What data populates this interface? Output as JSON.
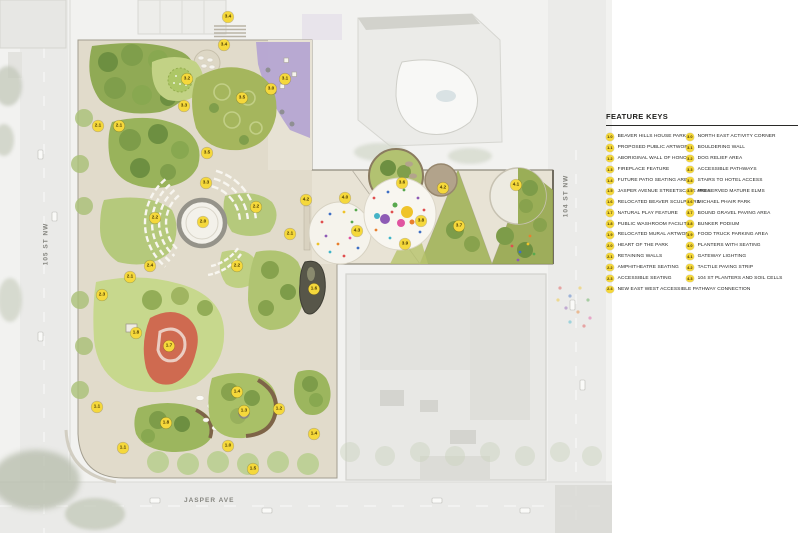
{
  "legend": {
    "title": "FEATURE KEYS",
    "columns": [
      {
        "items": [
          {
            "code": "1.0",
            "label": "BEAVER HILLS HOUSE PARK"
          },
          {
            "code": "1.1",
            "label": "PROPOSED PUBLIC ARTWORK"
          },
          {
            "code": "1.2",
            "label": "ABORIGINAL WALL OF HONOUR"
          },
          {
            "code": "1.3",
            "label": "FIREPLACE FEATURE"
          },
          {
            "code": "1.4",
            "label": "FUTURE PATIO SEATING AREA"
          },
          {
            "code": "1.5",
            "label": "JASPER AVENUE STREETSCAPE AREA"
          },
          {
            "code": "1.6",
            "label": "RELOCATED BEAVER SCULPTURE"
          },
          {
            "code": "1.7",
            "label": "NATURAL PLAY FEATURE"
          },
          {
            "code": "1.8",
            "label": "PUBLIC WASHROOM FACILITY"
          },
          {
            "code": "1.9",
            "label": "RELOCATED MURAL ARTWORK"
          },
          {
            "code": "2.0",
            "label": "HEART OF THE PARK"
          },
          {
            "code": "2.1",
            "label": "RETAINING WALLS"
          },
          {
            "code": "2.2",
            "label": "AMPHITHEATRE SEATING"
          },
          {
            "code": "2.3",
            "label": "ACCESSIBLE SEATING"
          },
          {
            "code": "2.4",
            "label": "NEW EAST WEST ACCESSIBLE PATHWAY CONNECTION"
          }
        ]
      },
      {
        "items": [
          {
            "code": "3.0",
            "label": "NORTH EAST ACTIVITY CORNER"
          },
          {
            "code": "3.1",
            "label": "BOULDERING WALL"
          },
          {
            "code": "3.2",
            "label": "DOG RELIEF AREA"
          },
          {
            "code": "3.3",
            "label": "ACCESSIBLE PATHWAYS"
          },
          {
            "code": "3.4",
            "label": "STAIRS TO HOTEL ACCESS"
          },
          {
            "code": "3.5",
            "label": "PRESERVED MATURE ELMS"
          },
          {
            "code": "3.6",
            "label": "MICHAEL PHAIR PARK"
          },
          {
            "code": "3.7",
            "label": "BOUND GRAVEL PAVING AREA"
          },
          {
            "code": "3.8",
            "label": "BUNKER PODIUM"
          },
          {
            "code": "3.9",
            "label": "FOOD TRUCK PARKING AREA"
          },
          {
            "code": "4.0",
            "label": "PLANTERS WITH SEATING"
          },
          {
            "code": "4.1",
            "label": "GATEWAY LIGHTING"
          },
          {
            "code": "4.2",
            "label": "TACTILE PAVING STRIP"
          },
          {
            "code": "4.3",
            "label": "104 ST PLANTERS AND SOIL CELLS"
          }
        ]
      }
    ]
  },
  "map": {
    "streets": [
      {
        "name": "105 ST NW"
      },
      {
        "name": "104 ST NW"
      },
      {
        "name": "JASPER AVE"
      }
    ],
    "marker_style": {
      "fill": "#F5D83B",
      "text": "#4A3A02"
    },
    "markers": [
      {
        "code": "3.4",
        "x": 228,
        "y": 17
      },
      {
        "code": "3.4",
        "x": 224,
        "y": 45
      },
      {
        "code": "3.2",
        "x": 187,
        "y": 79
      },
      {
        "code": "3.1",
        "x": 285,
        "y": 79
      },
      {
        "code": "3.0",
        "x": 271,
        "y": 89
      },
      {
        "code": "3.5",
        "x": 242,
        "y": 98
      },
      {
        "code": "3.3",
        "x": 184,
        "y": 106
      },
      {
        "code": "2.1",
        "x": 98,
        "y": 126
      },
      {
        "code": "2.1",
        "x": 119,
        "y": 126
      },
      {
        "code": "3.5",
        "x": 207,
        "y": 153
      },
      {
        "code": "3.3",
        "x": 206,
        "y": 183
      },
      {
        "code": "2.2",
        "x": 155,
        "y": 218
      },
      {
        "code": "2.0",
        "x": 203,
        "y": 222
      },
      {
        "code": "2.2",
        "x": 256,
        "y": 207
      },
      {
        "code": "4.2",
        "x": 306,
        "y": 200
      },
      {
        "code": "2.1",
        "x": 290,
        "y": 234
      },
      {
        "code": "2.4",
        "x": 150,
        "y": 266
      },
      {
        "code": "2.1",
        "x": 130,
        "y": 277
      },
      {
        "code": "2.3",
        "x": 102,
        "y": 295
      },
      {
        "code": "2.2",
        "x": 237,
        "y": 266
      },
      {
        "code": "1.6",
        "x": 314,
        "y": 289
      },
      {
        "code": "1.8",
        "x": 136,
        "y": 333
      },
      {
        "code": "1.7",
        "x": 169,
        "y": 346
      },
      {
        "code": "1.1",
        "x": 97,
        "y": 407
      },
      {
        "code": "1.4",
        "x": 237,
        "y": 392
      },
      {
        "code": "1.3",
        "x": 244,
        "y": 411
      },
      {
        "code": "1.2",
        "x": 279,
        "y": 409
      },
      {
        "code": "1.8",
        "x": 166,
        "y": 423
      },
      {
        "code": "1.1",
        "x": 123,
        "y": 448
      },
      {
        "code": "1.0",
        "x": 228,
        "y": 446
      },
      {
        "code": "1.5",
        "x": 253,
        "y": 469
      },
      {
        "code": "1.4",
        "x": 314,
        "y": 434
      },
      {
        "code": "4.0",
        "x": 345,
        "y": 198
      },
      {
        "code": "3.6",
        "x": 402,
        "y": 183
      },
      {
        "code": "4.2",
        "x": 443,
        "y": 188
      },
      {
        "code": "4.1",
        "x": 516,
        "y": 185
      },
      {
        "code": "4.3",
        "x": 357,
        "y": 231
      },
      {
        "code": "3.8",
        "x": 421,
        "y": 221
      },
      {
        "code": "3.7",
        "x": 459,
        "y": 226
      },
      {
        "code": "3.9",
        "x": 405,
        "y": 244
      }
    ]
  },
  "palette": {
    "paving": "#E1DBCB",
    "lawn_dark": "#90AA55",
    "lawn_mid": "#A5B65D",
    "lawn_light": "#C7D88D",
    "tree": "#6D8F41",
    "purple_bouldering": "#B5A5D2",
    "red_play": "#CF6A50",
    "confetti": [
      "#E04F4F",
      "#3F6FC4",
      "#EFC32A",
      "#58A84E",
      "#8E5BB5",
      "#E87F2E",
      "#E054A0",
      "#40B5C9"
    ],
    "aerial_grey": "#F2F2F0"
  }
}
